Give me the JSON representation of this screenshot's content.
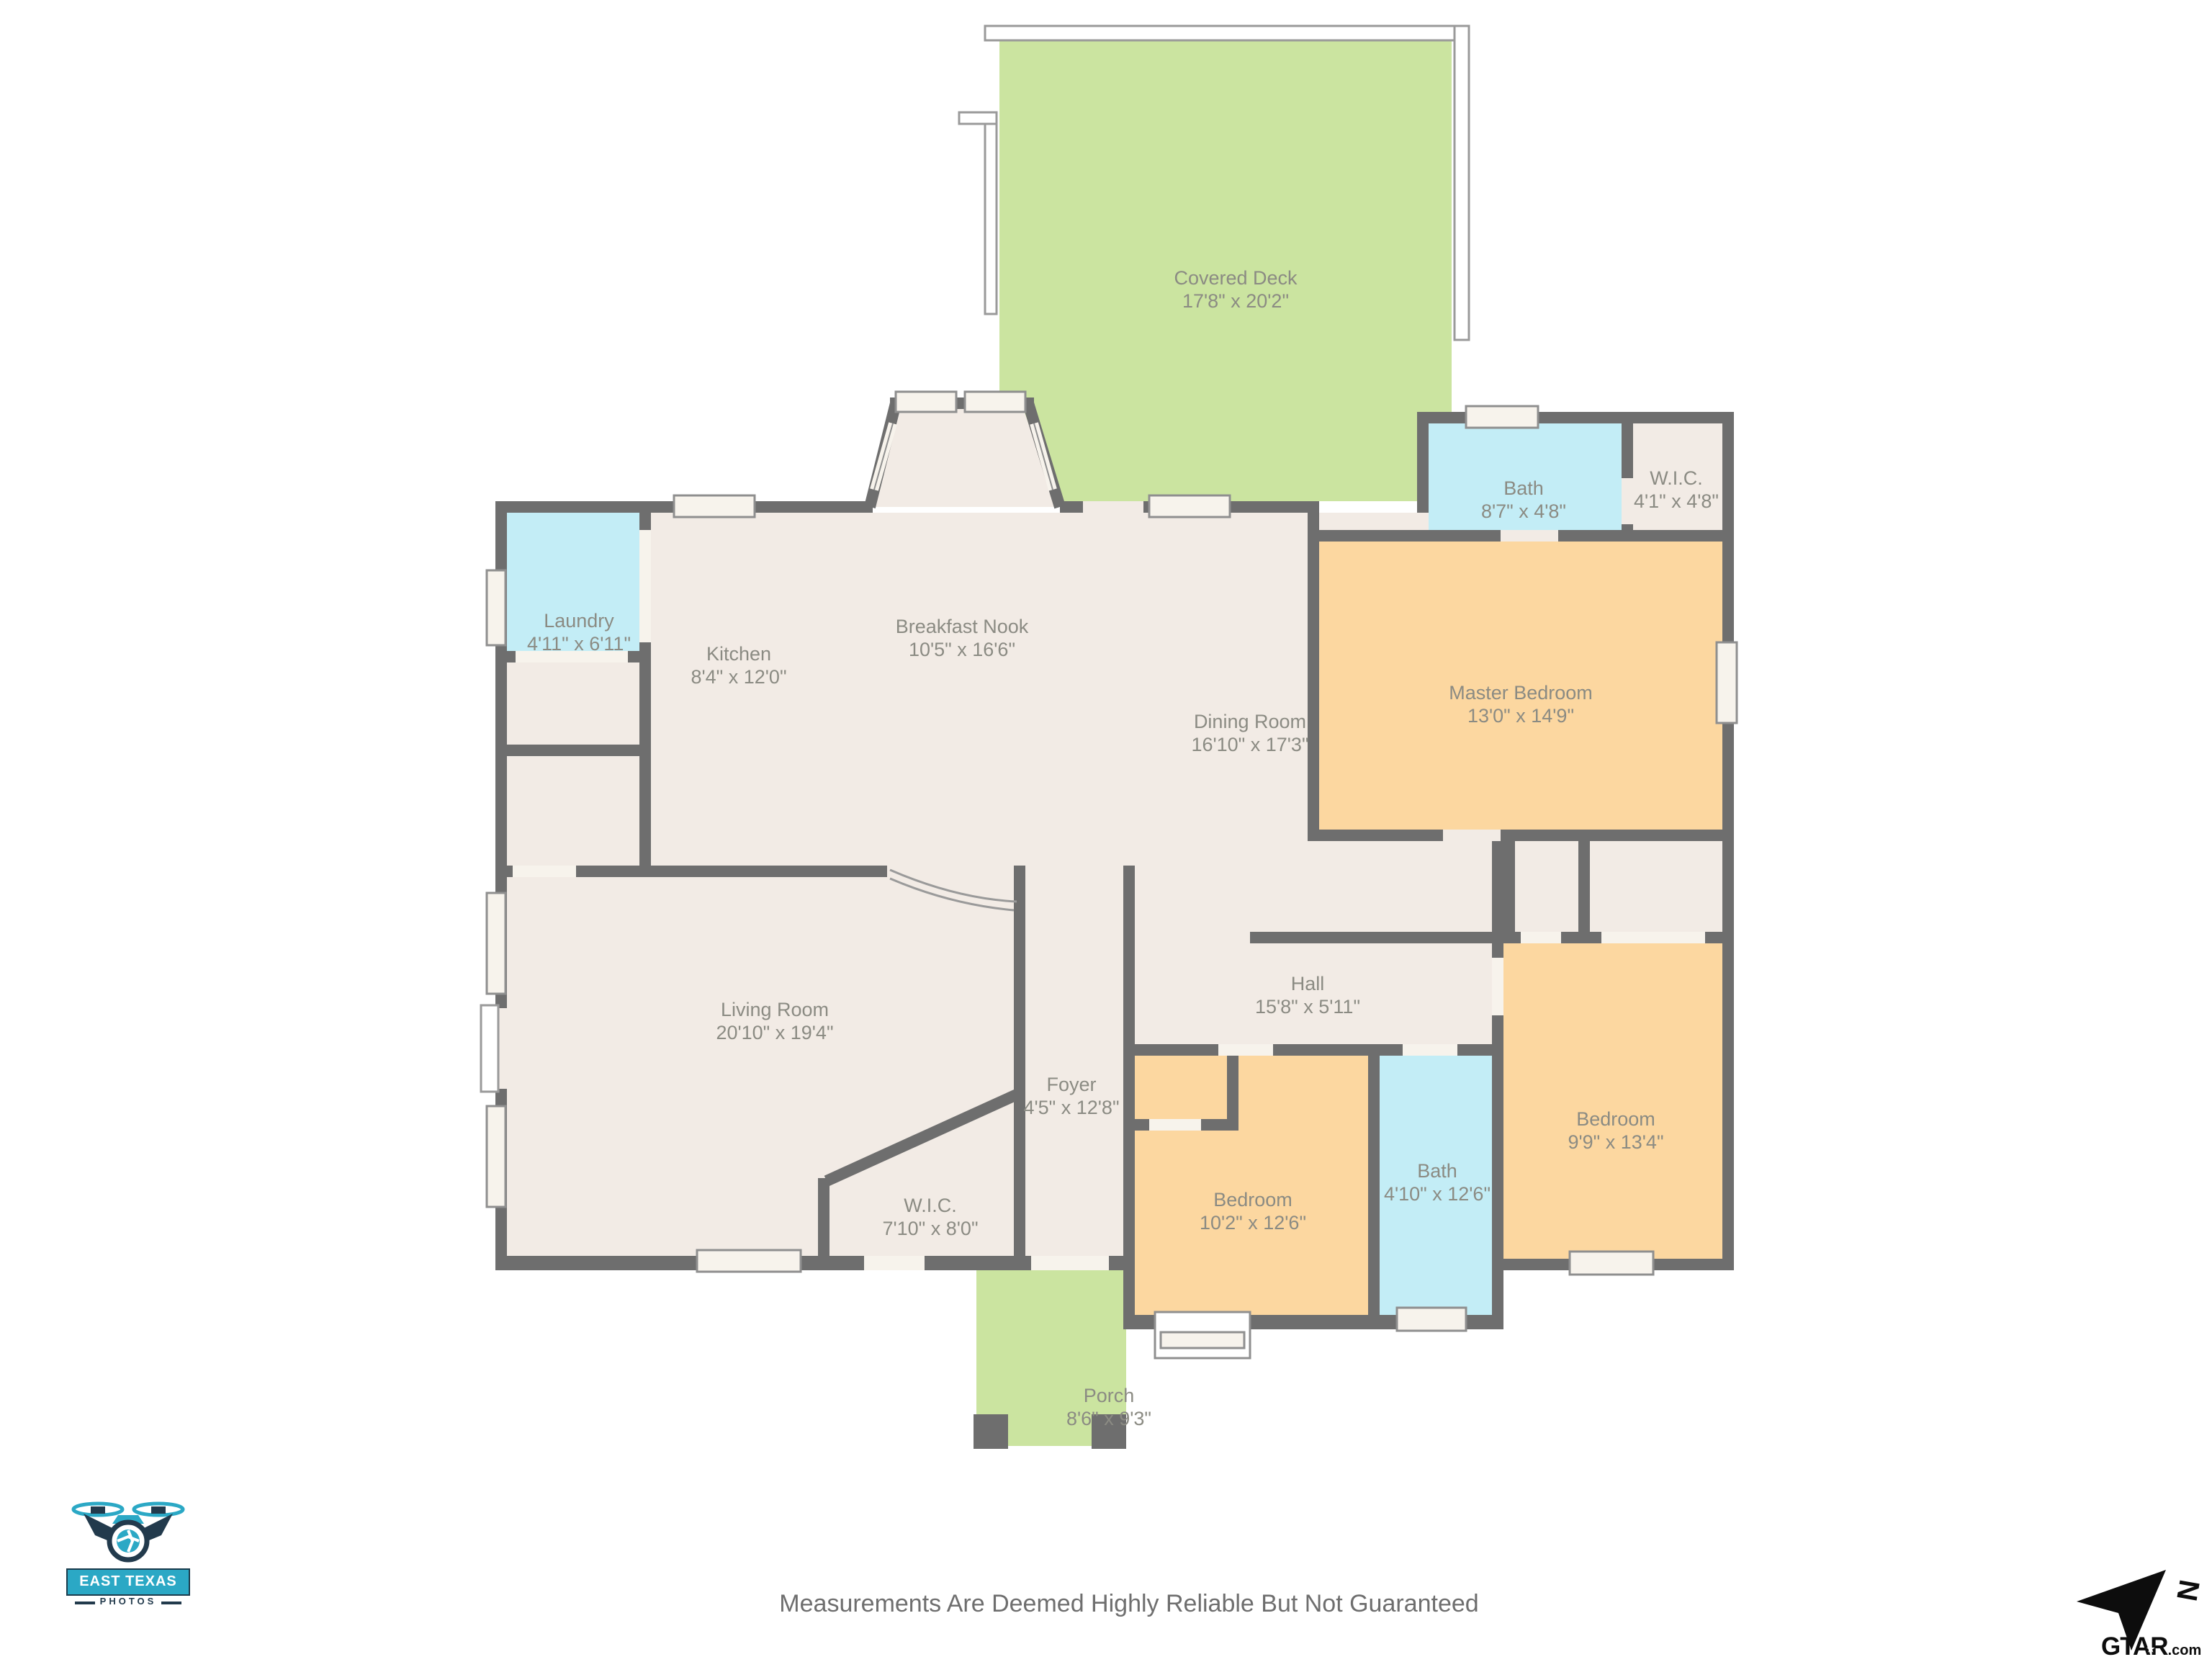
{
  "rooms": [
    {
      "name": "Covered Deck",
      "dims": "17'8\" x 20'2\""
    },
    {
      "name": "Bath",
      "dims": "8'7\" x 4'8\""
    },
    {
      "name": "W.I.C.",
      "dims": "4'1\" x 4'8\""
    },
    {
      "name": "Laundry",
      "dims": "4'11\" x 6'11\""
    },
    {
      "name": "Kitchen",
      "dims": "8'4\" x 12'0\""
    },
    {
      "name": "Breakfast Nook",
      "dims": "10'5\" x 16'6\""
    },
    {
      "name": "Dining Room",
      "dims": "16'10\" x 17'3\""
    },
    {
      "name": "Master Bedroom",
      "dims": "13'0\" x 14'9\""
    },
    {
      "name": "Living Room",
      "dims": "20'10\" x 19'4\""
    },
    {
      "name": "Hall",
      "dims": "15'8\" x 5'11\""
    },
    {
      "name": "Foyer",
      "dims": "4'5\" x 12'8\""
    },
    {
      "name": "W.I.C.",
      "dims": "7'10\" x 8'0\""
    },
    {
      "name": "Bedroom",
      "dims": "10'2\" x 12'6\""
    },
    {
      "name": "Bath",
      "dims": "4'10\" x 12'6\""
    },
    {
      "name": "Bedroom",
      "dims": "9'9\" x 13'4\""
    },
    {
      "name": "Porch",
      "dims": "8'6\" x 9'3\""
    }
  ],
  "footer": {
    "disclaimer": "Measurements Are Deemed Highly Reliable But Not Guaranteed"
  },
  "logo": {
    "line1": "EAST TEXAS",
    "line2": "PHOTOS"
  },
  "branding": {
    "site": "GTAR",
    "star": "★",
    "tld": ".com"
  },
  "compass": {
    "north": "N"
  },
  "colors": {
    "wall": "#6e6e6e",
    "floor": "#f2ebe5",
    "bedroom": "#fcd7a0",
    "bath": "#c3edf6",
    "outdoor": "#cbe4a0",
    "label": "#8b8b83",
    "logo_teal": "#2ba8c5",
    "logo_navy": "#223a4c"
  }
}
